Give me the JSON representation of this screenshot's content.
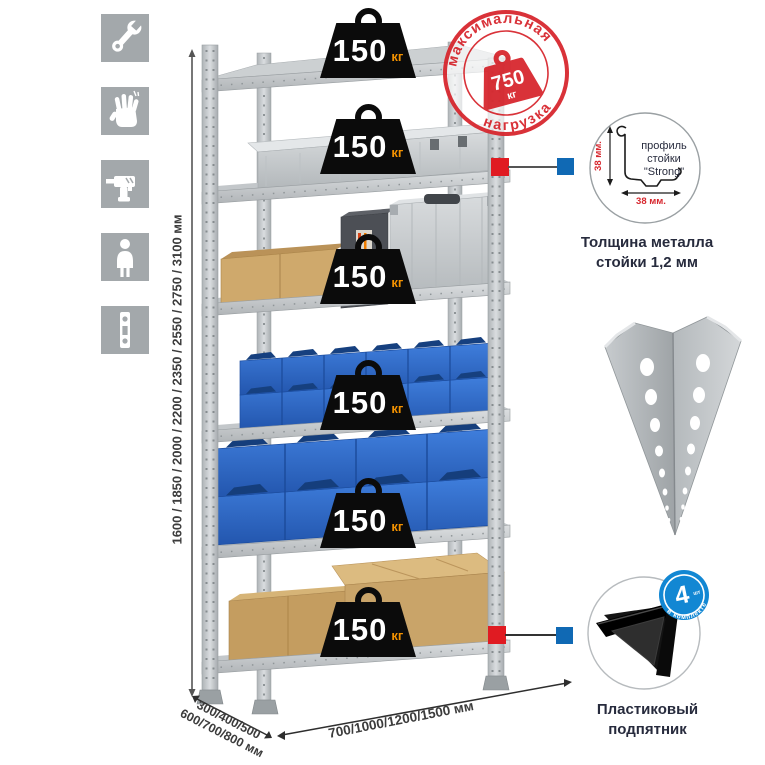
{
  "sidebar": {
    "icons": [
      {
        "name": "wrench"
      },
      {
        "name": "gloves"
      },
      {
        "name": "drill"
      },
      {
        "name": "person"
      },
      {
        "name": "level"
      }
    ]
  },
  "height_dimension": {
    "label": "1600 / 1850 / 2000 / 2200 / 2350 / 2550 / 2750 / 3100 мм"
  },
  "bottom_dimensions": {
    "depth_line1": "300/400/500",
    "depth_line2": "600/700/800 мм",
    "width": "700/1000/1200/1500 мм"
  },
  "max_load_stamp": {
    "arc_top": "максимальная",
    "arc_bottom": "нагрузка",
    "value": "750",
    "unit": "кг"
  },
  "shelves": [
    {
      "load": "150",
      "unit": "кг"
    },
    {
      "load": "150",
      "unit": "кг"
    },
    {
      "load": "150",
      "unit": "кг"
    },
    {
      "load": "150",
      "unit": "кг"
    },
    {
      "load": "150",
      "unit": "кг"
    },
    {
      "load": "150",
      "unit": "кг"
    }
  ],
  "profile_detail": {
    "label_line1": "профиль",
    "label_line2": "стойки",
    "label_line3": "\"Strong\"",
    "dim_vertical": "38 мм.",
    "dim_horizontal": "38 мм.",
    "caption_line1": "Толщина металла",
    "caption_line2": "стойки 1,2 мм"
  },
  "foot_detail": {
    "badge_value": "4",
    "badge_small": "шт",
    "badge_arc": "в комплекте",
    "caption_line1": "Пластиковый",
    "caption_line2": "подпятник"
  },
  "colors": {
    "stamp_red": "#d7282f",
    "accent_red": "#e01b22",
    "accent_blue": "#1069b4",
    "bin_blue": "#2b66c4",
    "badge_black": "#0b0b0b",
    "kg_orange": "#f29100",
    "caption_navy": "#272b3d"
  }
}
